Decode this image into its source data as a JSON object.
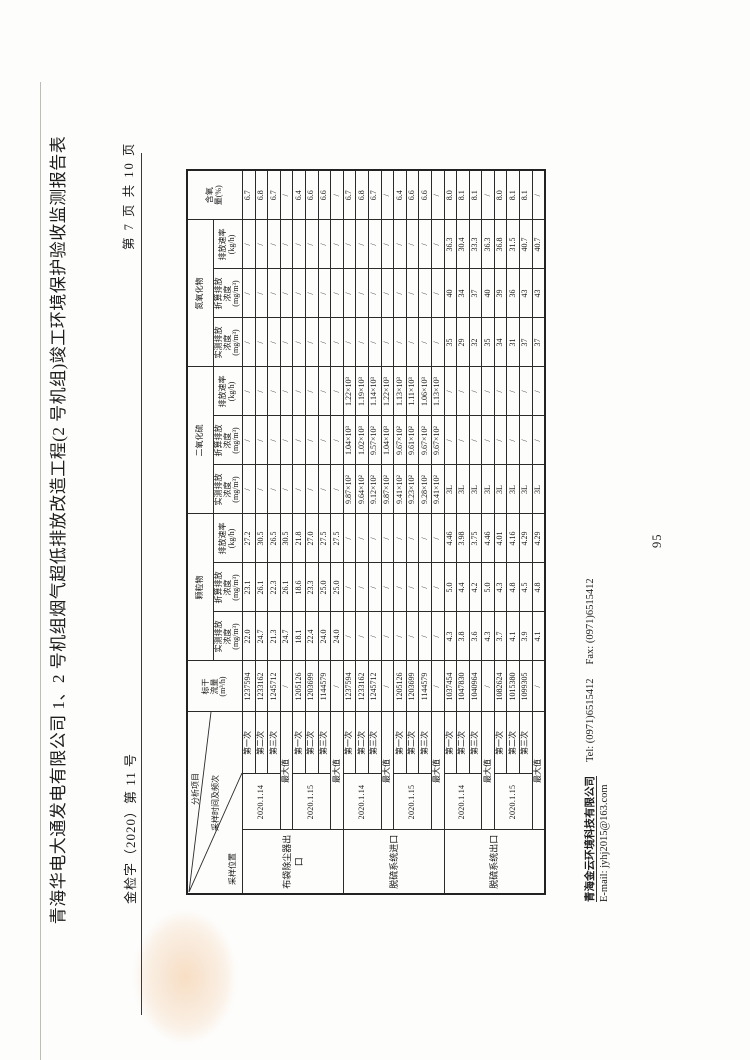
{
  "header": {
    "doc_number": "金检字（2020）第 11 号",
    "page_indicator": "第 7 页 共 10 页",
    "title": "青海华电大通发电有限公司 1、2 号机组烟气超低排放改造工程(2 号机组)竣工环境保护验收监测报告表"
  },
  "table": {
    "diagonal": {
      "project": "分析项目",
      "time": "采样时间及频次",
      "position": "采样位置"
    },
    "flow_header": {
      "label": "标干",
      "label2": "流量",
      "unit": "(m³/h)"
    },
    "o2_header": {
      "label": "含氧",
      "label2": "量(%)",
      "unit": ""
    },
    "groups": [
      "颗粒物",
      "二氧化硫",
      "氮氧化物"
    ],
    "sub_headers": [
      {
        "label": "实测排放",
        "label2": "浓度",
        "unit": "(mg/m³)"
      },
      {
        "label": "折算排放",
        "label2": "浓度",
        "unit": "(mg/m³)"
      },
      {
        "label": "排放速率",
        "label2": "",
        "unit": "(kg/h)"
      }
    ],
    "max_label": "最大值",
    "locations": [
      {
        "name": "布袋除尘器出口",
        "blocks": [
          {
            "date": "2020.1.14",
            "runs": [
              {
                "label": "第一次",
                "cells": [
                  "1237594",
                  "22.0",
                  "23.1",
                  "27.2",
                  "/",
                  "/",
                  "/",
                  "/",
                  "/",
                  "/",
                  "6.7"
                ]
              },
              {
                "label": "第二次",
                "cells": [
                  "1233162",
                  "24.7",
                  "26.1",
                  "30.5",
                  "/",
                  "/",
                  "/",
                  "/",
                  "/",
                  "/",
                  "6.8"
                ]
              },
              {
                "label": "第三次",
                "cells": [
                  "1245712",
                  "21.3",
                  "22.3",
                  "26.5",
                  "/",
                  "/",
                  "/",
                  "/",
                  "/",
                  "/",
                  "6.7"
                ]
              }
            ],
            "max": [
              "/",
              "24.7",
              "26.1",
              "30.5",
              "/",
              "/",
              "/",
              "/",
              "/",
              "/",
              "/"
            ]
          },
          {
            "date": "2020.1.15",
            "runs": [
              {
                "label": "第一次",
                "cells": [
                  "1205126",
                  "18.1",
                  "18.6",
                  "21.8",
                  "/",
                  "/",
                  "/",
                  "/",
                  "/",
                  "/",
                  "6.4"
                ]
              },
              {
                "label": "第二次",
                "cells": [
                  "1203699",
                  "22.4",
                  "23.3",
                  "27.0",
                  "/",
                  "/",
                  "/",
                  "/",
                  "/",
                  "/",
                  "6.6"
                ]
              },
              {
                "label": "第三次",
                "cells": [
                  "1144579",
                  "24.0",
                  "25.0",
                  "27.5",
                  "/",
                  "/",
                  "/",
                  "/",
                  "/",
                  "/",
                  "6.6"
                ]
              }
            ],
            "max": [
              "/",
              "24.0",
              "25.0",
              "27.5",
              "/",
              "/",
              "/",
              "/",
              "/",
              "/",
              "/"
            ]
          }
        ]
      },
      {
        "name": "脱硫系统进口",
        "blocks": [
          {
            "date": "2020.1.14",
            "runs": [
              {
                "label": "第一次",
                "cells": [
                  "1237594",
                  "/",
                  "/",
                  "/",
                  "9.87×10²",
                  "1.04×10³",
                  "1.22×10³",
                  "/",
                  "/",
                  "/",
                  "6.7"
                ]
              },
              {
                "label": "第二次",
                "cells": [
                  "1233162",
                  "/",
                  "/",
                  "/",
                  "9.64×10²",
                  "1.02×10³",
                  "1.19×10³",
                  "/",
                  "/",
                  "/",
                  "6.8"
                ]
              },
              {
                "label": "第三次",
                "cells": [
                  "1245712",
                  "/",
                  "/",
                  "/",
                  "9.12×10²",
                  "9.57×10²",
                  "1.14×10³",
                  "/",
                  "/",
                  "/",
                  "6.7"
                ]
              }
            ],
            "max": [
              "/",
              "/",
              "/",
              "/",
              "9.87×10²",
              "1.04×10³",
              "1.22×10³",
              "/",
              "/",
              "/",
              "/"
            ]
          },
          {
            "date": "2020.1.15",
            "runs": [
              {
                "label": "第一次",
                "cells": [
                  "1205126",
                  "/",
                  "/",
                  "/",
                  "9.41×10²",
                  "9.67×10²",
                  "1.13×10³",
                  "/",
                  "/",
                  "/",
                  "6.4"
                ]
              },
              {
                "label": "第二次",
                "cells": [
                  "1203699",
                  "/",
                  "/",
                  "/",
                  "9.23×10²",
                  "9.61×10²",
                  "1.11×10³",
                  "/",
                  "/",
                  "/",
                  "6.6"
                ]
              },
              {
                "label": "第三次",
                "cells": [
                  "1144579",
                  "/",
                  "/",
                  "/",
                  "9.28×10²",
                  "9.67×10²",
                  "1.06×10³",
                  "/",
                  "/",
                  "/",
                  "6.6"
                ]
              }
            ],
            "max": [
              "/",
              "/",
              "/",
              "/",
              "9.41×10²",
              "9.67×10²",
              "1.13×10³",
              "/",
              "/",
              "/",
              "/"
            ]
          }
        ]
      },
      {
        "name": "脱硫系统出口",
        "blocks": [
          {
            "date": "2020.1.14",
            "runs": [
              {
                "label": "第一次",
                "cells": [
                  "1037454",
                  "4.3",
                  "5.0",
                  "4.46",
                  "3L",
                  "/",
                  "/",
                  "35",
                  "40",
                  "36.3",
                  "8.0"
                ]
              },
              {
                "label": "第二次",
                "cells": [
                  "1047830",
                  "3.8",
                  "4.4",
                  "3.98",
                  "3L",
                  "/",
                  "/",
                  "29",
                  "34",
                  "30.4",
                  "8.1"
                ]
              },
              {
                "label": "第三次",
                "cells": [
                  "1040964",
                  "3.6",
                  "4.2",
                  "3.75",
                  "3L",
                  "/",
                  "/",
                  "32",
                  "37",
                  "33.3",
                  "8.1"
                ]
              }
            ],
            "max": [
              "/",
              "4.3",
              "5.0",
              "4.46",
              "3L",
              "/",
              "/",
              "35",
              "40",
              "36.3",
              "/"
            ]
          },
          {
            "date": "2020.1.15",
            "runs": [
              {
                "label": "第一次",
                "cells": [
                  "1082624",
                  "3.7",
                  "4.3",
                  "4.01",
                  "3L",
                  "/",
                  "/",
                  "34",
                  "39",
                  "36.8",
                  "8.0"
                ]
              },
              {
                "label": "第二次",
                "cells": [
                  "1015380",
                  "4.1",
                  "4.8",
                  "4.16",
                  "3L",
                  "/",
                  "/",
                  "31",
                  "36",
                  "31.5",
                  "8.1"
                ]
              },
              {
                "label": "第三次",
                "cells": [
                  "1099305",
                  "3.9",
                  "4.5",
                  "4.29",
                  "3L",
                  "/",
                  "/",
                  "37",
                  "43",
                  "40.7",
                  "8.1"
                ]
              }
            ],
            "max": [
              "/",
              "4.1",
              "4.8",
              "4.29",
              "3L",
              "/",
              "/",
              "37",
              "43",
              "40.7",
              "/"
            ]
          }
        ]
      }
    ]
  },
  "footer": {
    "company": "青海金云环境科技有限公司",
    "tel": "Tel:  (0971)6515412",
    "fax": "Fax:  (0971)6515412",
    "email": "E-mail:  jyhj2015@163.com",
    "report_page": "95"
  }
}
